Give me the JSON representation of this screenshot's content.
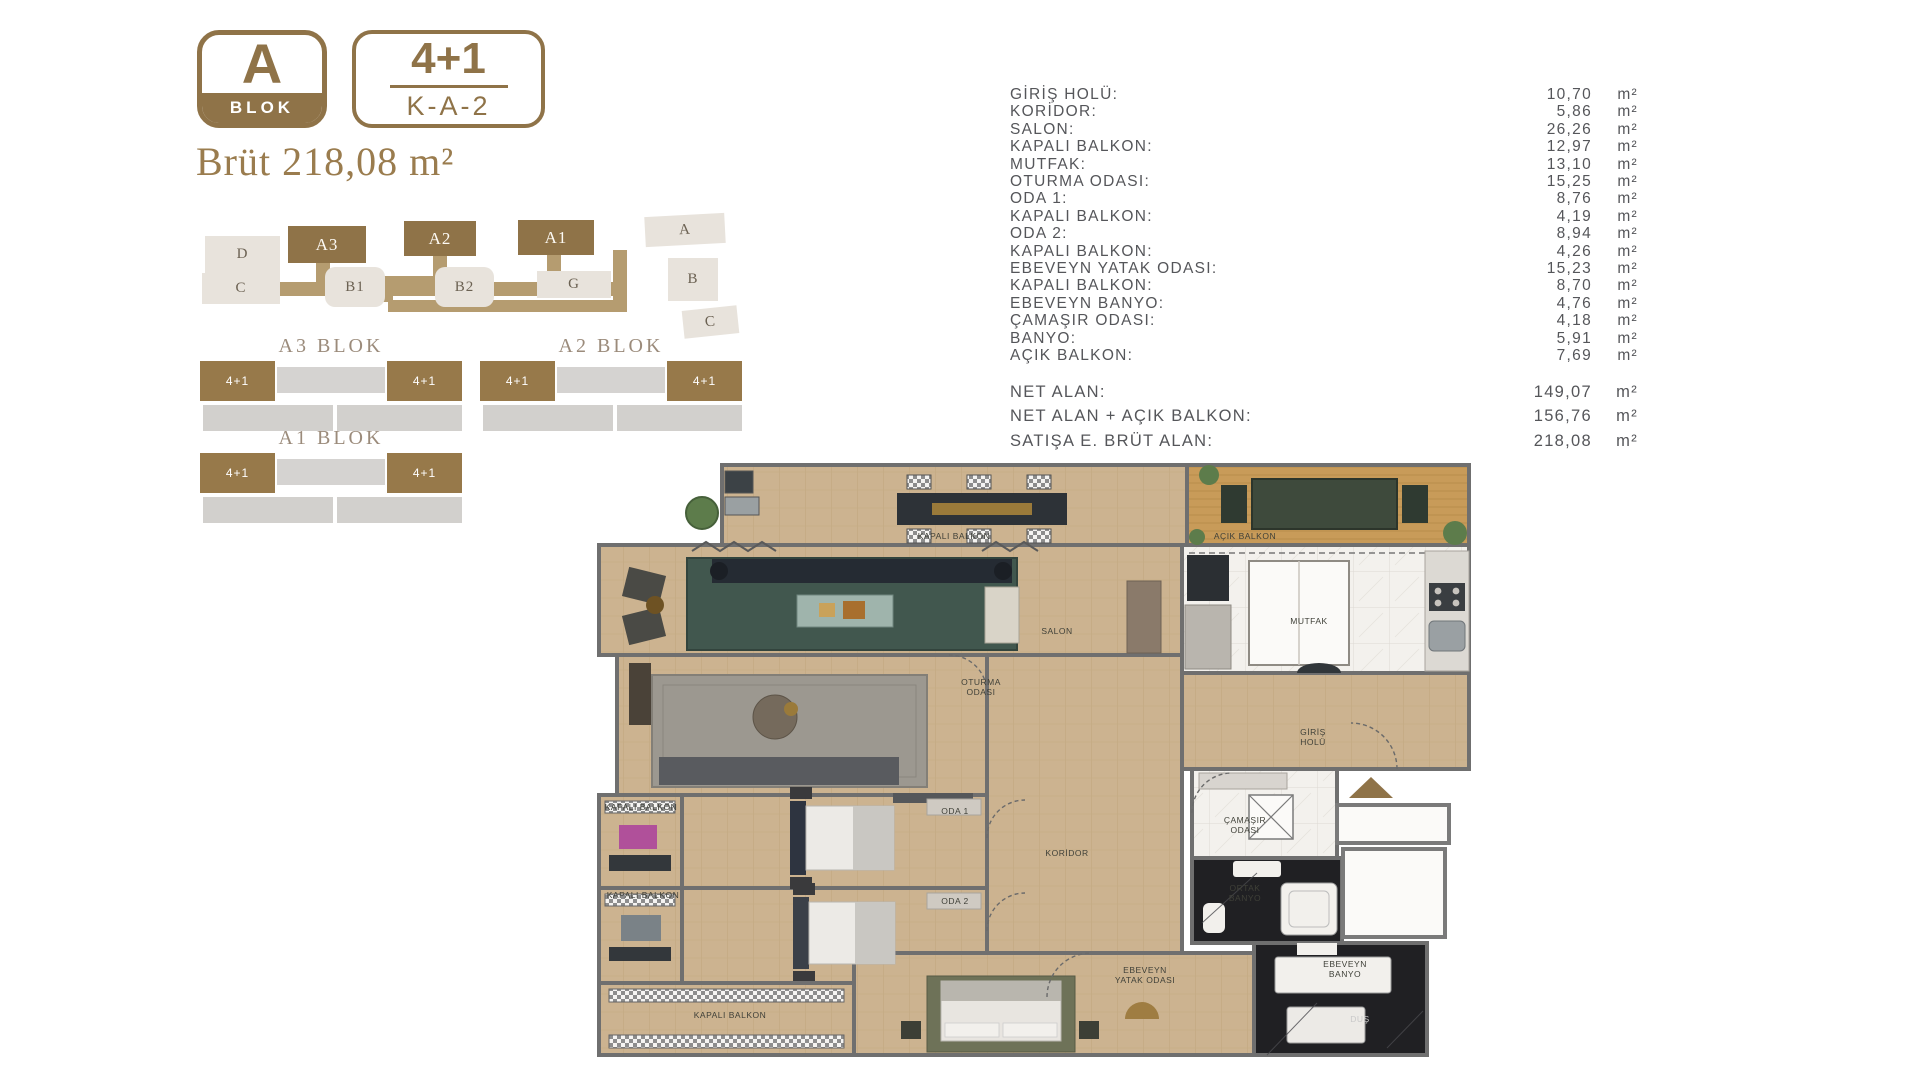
{
  "colors": {
    "gold": "#8f7348",
    "road": "#b59c70",
    "light_block": "#e8e3dc",
    "text_gray": "#55565a",
    "wood": "#ccb390",
    "deck_ochre": "#c89b59",
    "marble_white": "#f3f1ed",
    "black_marble": "#202023",
    "rug_teal": "#41574e"
  },
  "header": {
    "block_letter": "A",
    "block_word": "BLOK",
    "unit_type": "4+1",
    "unit_code": "K-A-2",
    "gross_text": "Brüt 218,08 m²"
  },
  "site_plan": {
    "blocks": [
      {
        "label": "D",
        "type": "gray",
        "x": 10,
        "y": 26,
        "w": 75,
        "h": 37,
        "rot": 0
      },
      {
        "label": "C",
        "type": "gray",
        "x": 7,
        "y": 63,
        "w": 78,
        "h": 31,
        "rot": 0
      },
      {
        "label": "A3",
        "type": "gold",
        "x": 93,
        "y": 16,
        "w": 78,
        "h": 37,
        "rot": 0
      },
      {
        "label": "A2",
        "type": "gold",
        "x": 209,
        "y": 11,
        "w": 72,
        "h": 35,
        "rot": 0
      },
      {
        "label": "A1",
        "type": "gold",
        "x": 323,
        "y": 10,
        "w": 76,
        "h": 35,
        "rot": 0
      },
      {
        "label": "B1",
        "type": "gray blob",
        "x": 130,
        "y": 57,
        "w": 60,
        "h": 40,
        "rot": 0
      },
      {
        "label": "B2",
        "type": "gray blob",
        "x": 240,
        "y": 57,
        "w": 59,
        "h": 40,
        "rot": 0
      },
      {
        "label": "G",
        "type": "gray",
        "x": 342,
        "y": 61,
        "w": 74,
        "h": 27,
        "rot": 0
      },
      {
        "label": "A",
        "type": "gray",
        "x": 450,
        "y": 5,
        "w": 80,
        "h": 30,
        "rot": -3
      },
      {
        "label": "B",
        "type": "gray",
        "x": 473,
        "y": 48,
        "w": 50,
        "h": 43,
        "rot": 0
      },
      {
        "label": "C",
        "type": "gray",
        "x": 488,
        "y": 98,
        "w": 55,
        "h": 28,
        "rot": -6
      }
    ]
  },
  "mini_blocks": [
    {
      "title": "A3 BLOK",
      "units": [
        "4+1",
        "4+1"
      ],
      "x": 5,
      "y": 0
    },
    {
      "title": "A2 BLOK",
      "units": [
        "4+1",
        "4+1"
      ],
      "x": 285,
      "y": 0
    },
    {
      "title": "A1 BLOK",
      "units": [
        "4+1",
        "4+1"
      ],
      "x": 5,
      "y": 92
    }
  ],
  "area_table": {
    "rows": [
      {
        "label": "GİRİŞ HOLÜ:",
        "value": "10,70",
        "unit": "m²"
      },
      {
        "label": "KORİDOR:",
        "value": "5,86",
        "unit": "m²"
      },
      {
        "label": "SALON:",
        "value": "26,26",
        "unit": "m²"
      },
      {
        "label": "KAPALI BALKON:",
        "value": "12,97",
        "unit": "m²"
      },
      {
        "label": "MUTFAK:",
        "value": "13,10",
        "unit": "m²"
      },
      {
        "label": "OTURMA ODASI:",
        "value": "15,25",
        "unit": "m²"
      },
      {
        "label": "ODA 1:",
        "value": "8,76",
        "unit": "m²"
      },
      {
        "label": "KAPALI BALKON:",
        "value": "4,19",
        "unit": "m²"
      },
      {
        "label": "ODA 2:",
        "value": "8,94",
        "unit": "m²"
      },
      {
        "label": "KAPALI BALKON:",
        "value": "4,26",
        "unit": "m²"
      },
      {
        "label": "EBEVEYN YATAK ODASI:",
        "value": "15,23",
        "unit": "m²"
      },
      {
        "label": "KAPALI BALKON:",
        "value": "8,70",
        "unit": "m²"
      },
      {
        "label": "EBEVEYN BANYO:",
        "value": "4,76",
        "unit": "m²"
      },
      {
        "label": "ÇAMAŞIR ODASI:",
        "value": "4,18",
        "unit": "m²"
      },
      {
        "label": "BANYO:",
        "value": "5,91",
        "unit": "m²"
      },
      {
        "label": "AÇIK BALKON:",
        "value": "7,69",
        "unit": "m²"
      }
    ],
    "totals": [
      {
        "label": "NET ALAN:",
        "value": "149,07",
        "unit": "m²"
      },
      {
        "label": "NET ALAN + AÇIK BALKON:",
        "value": "156,76",
        "unit": "m²"
      },
      {
        "label": "SATIŞA E. BRÜT ALAN:",
        "value": "218,08",
        "unit": "m²"
      }
    ]
  },
  "floorplan": {
    "labels": [
      {
        "text": "KAPALI BALKON",
        "x": 357,
        "y": 73
      },
      {
        "text": "AÇIK BALKON",
        "x": 648,
        "y": 73
      },
      {
        "text": "SALON",
        "x": 460,
        "y": 168
      },
      {
        "text": "MUTFAK",
        "x": 712,
        "y": 158
      },
      {
        "text": "OTURMA\nODASI",
        "x": 384,
        "y": 224
      },
      {
        "text": "GİRİŞ\nHOLÜ",
        "x": 716,
        "y": 274
      },
      {
        "text": "ODA 1",
        "x": 358,
        "y": 348
      },
      {
        "text": "ODA 2",
        "x": 358,
        "y": 438
      },
      {
        "text": "KORİDOR",
        "x": 470,
        "y": 390
      },
      {
        "text": "KAPALI BALKON",
        "x": 44,
        "y": 344
      },
      {
        "text": "KAPALI BALKON",
        "x": 46,
        "y": 432
      },
      {
        "text": "KAPALI BALKON",
        "x": 133,
        "y": 552
      },
      {
        "text": "ÇAMAŞIR\nODASI",
        "x": 648,
        "y": 362
      },
      {
        "text": "ORTAK\nBANYO",
        "x": 648,
        "y": 430
      },
      {
        "text": "EBEVEYN\nYATAK ODASI",
        "x": 548,
        "y": 512
      },
      {
        "text": "EBEVEYN\nBANYO",
        "x": 748,
        "y": 506
      },
      {
        "text": "DUŞ",
        "x": 763,
        "y": 556,
        "light": true
      }
    ]
  }
}
